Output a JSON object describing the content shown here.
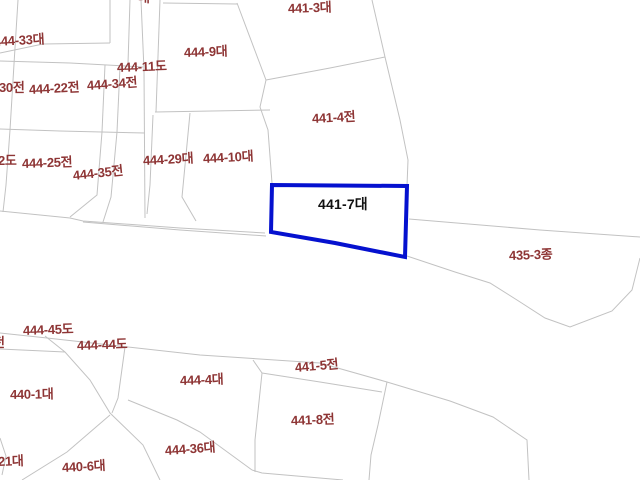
{
  "app": {
    "type": "cadastral-parcel-map",
    "background_color": "#ffffff"
  },
  "colors": {
    "parcel_boundary_line": "#c2c2c2",
    "parcel_label_text": "#8e3535",
    "selected_parcel_outline": "#0511cf",
    "selected_parcel_label_text": "#111111"
  },
  "selected_parcel": {
    "label": "441-7대"
  },
  "labels": [
    "444-33대",
    "444-9대",
    "441-3대",
    "444-11도",
    "30전",
    "444-22전",
    "444-34전",
    "441-4전",
    "2도",
    "444-25전",
    "444-35전",
    "444-29대",
    "444-10대",
    "441-7대",
    "435-3종",
    "444-45도",
    "444-44도",
    "전",
    "440-1대",
    "444-4대",
    "441-5전",
    "441-8전",
    "444-36대",
    "440-6대",
    "21대",
    "대"
  ]
}
